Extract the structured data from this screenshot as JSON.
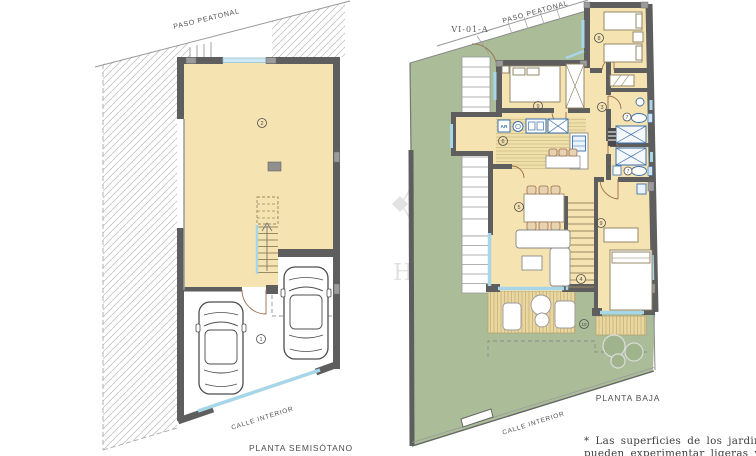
{
  "colors": {
    "wall": "#5e5e5e",
    "pillar": "#9b9b9b",
    "floor_cream": "#f6e3b2",
    "deck_tan": "#e9d7a2",
    "deck_stripe": "#c9b176",
    "garden_green": "#aabd98",
    "window_blue": "#a7d6e9",
    "fixture_blue": "#3b6fae",
    "door_brown": "#9c6b4f",
    "hatch_gray": "#c5c5c5",
    "watermark_gray": "#dedede"
  },
  "watermark": {
    "text": "HOMES"
  },
  "plan_left": {
    "title": "PLANTA SEMISÓTANO",
    "label_top": "PASO PEATONAL",
    "label_street": "CALLE INTERIOR",
    "room_numbers": {
      "garage": "1",
      "basement_room": "2"
    }
  },
  "plan_right": {
    "title": "PLANTA BAJA",
    "unit_code": "VI-01-A",
    "label_top": "PASO PEATONAL",
    "label_street": "CALLE INTERIOR",
    "kitchen_tag": "AR",
    "room_numbers": {
      "hall": "3",
      "stairs": "4",
      "living": "5",
      "kitchen": "6",
      "bath_1": "7",
      "bath_2": "7",
      "bedroom_top": "8",
      "bedroom_left": "9",
      "bedroom_right": "9",
      "terrace": "10"
    }
  },
  "footnote": {
    "line1": "* Las superficies de los jardines",
    "line2": "pueden experimentar ligeras va-"
  }
}
